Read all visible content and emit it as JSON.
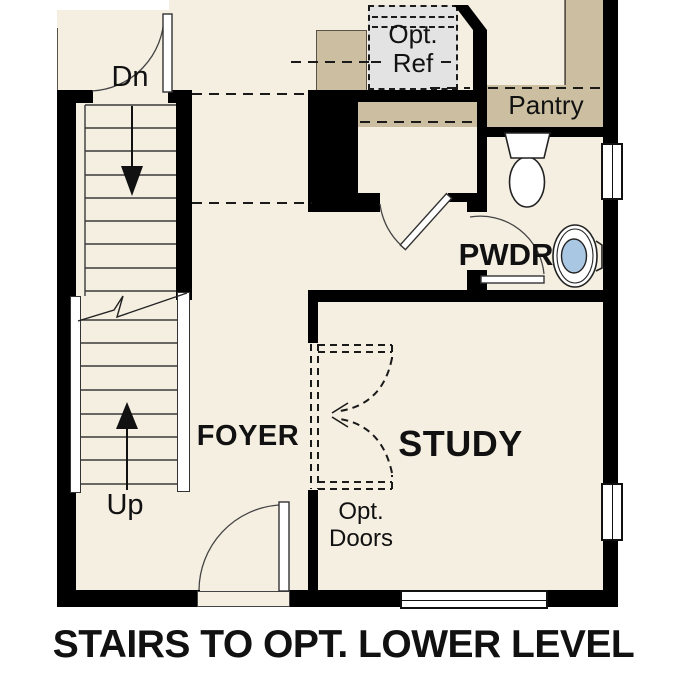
{
  "title": "STAIRS TO OPT. LOWER LEVEL",
  "rooms": {
    "foyer": "FOYER",
    "study": "STUDY",
    "powder_room": "PWDR",
    "pantry": "Pantry"
  },
  "stairs": {
    "down_label": "Dn",
    "up_label": "Up"
  },
  "options": {
    "ref": {
      "line1": "Opt.",
      "line2": "Ref"
    },
    "doors": {
      "line1": "Opt.",
      "line2": "Doors"
    }
  },
  "fixtures": {
    "toilet": "toilet-icon",
    "sink": "pedestal-sink-icon"
  },
  "colors": {
    "floor": "#F5EFE2",
    "wall": "#000000",
    "cabinetry_tan": "#CBBEA1",
    "appliance_grey": "#E3E3E3",
    "sink_basin_blue": "#A9C6E3",
    "background": "#FFFFFF"
  }
}
